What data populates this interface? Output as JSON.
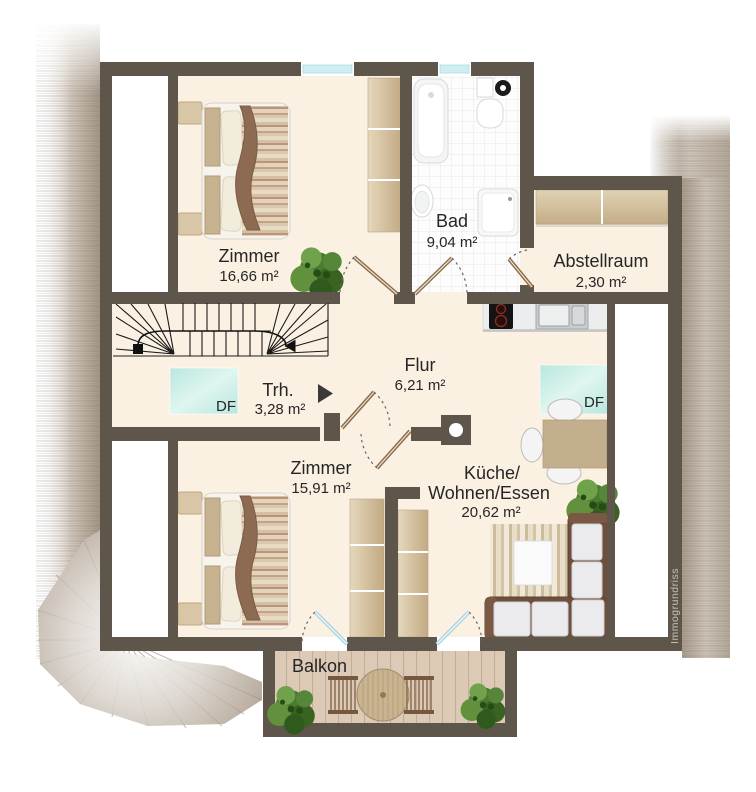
{
  "plan": {
    "watermark": "Immogrundriss",
    "skylight_label": "DF",
    "rooms": {
      "zimmer_top": {
        "name": "Zimmer",
        "area": "16,66 m²"
      },
      "bad": {
        "name": "Bad",
        "area": "9,04 m²"
      },
      "abstellraum": {
        "name": "Abstellraum",
        "area": "2,30 m²"
      },
      "treppenhaus": {
        "name": "Trh.",
        "area": "3,28 m²"
      },
      "flur": {
        "name": "Flur",
        "area": "6,21 m²"
      },
      "zimmer_bottom": {
        "name": "Zimmer",
        "area": "15,91 m²"
      },
      "kueche": {
        "name_line1": "Küche/",
        "name_line2": "Wohnen/Essen",
        "area": "20,62 m²"
      },
      "balkon": {
        "name": "Balkon"
      }
    },
    "colors": {
      "wall": "#5f564b",
      "floor": "#fbf1e3",
      "bath_tile": "#fdfdfd",
      "window_glass": "#cdeef2",
      "skylight_glass": "#c7ebe3",
      "roof": "#b2a595",
      "wood": "#d3bf9e",
      "door_leaf": "#8a6a4a",
      "deck": "#dccab7"
    }
  }
}
